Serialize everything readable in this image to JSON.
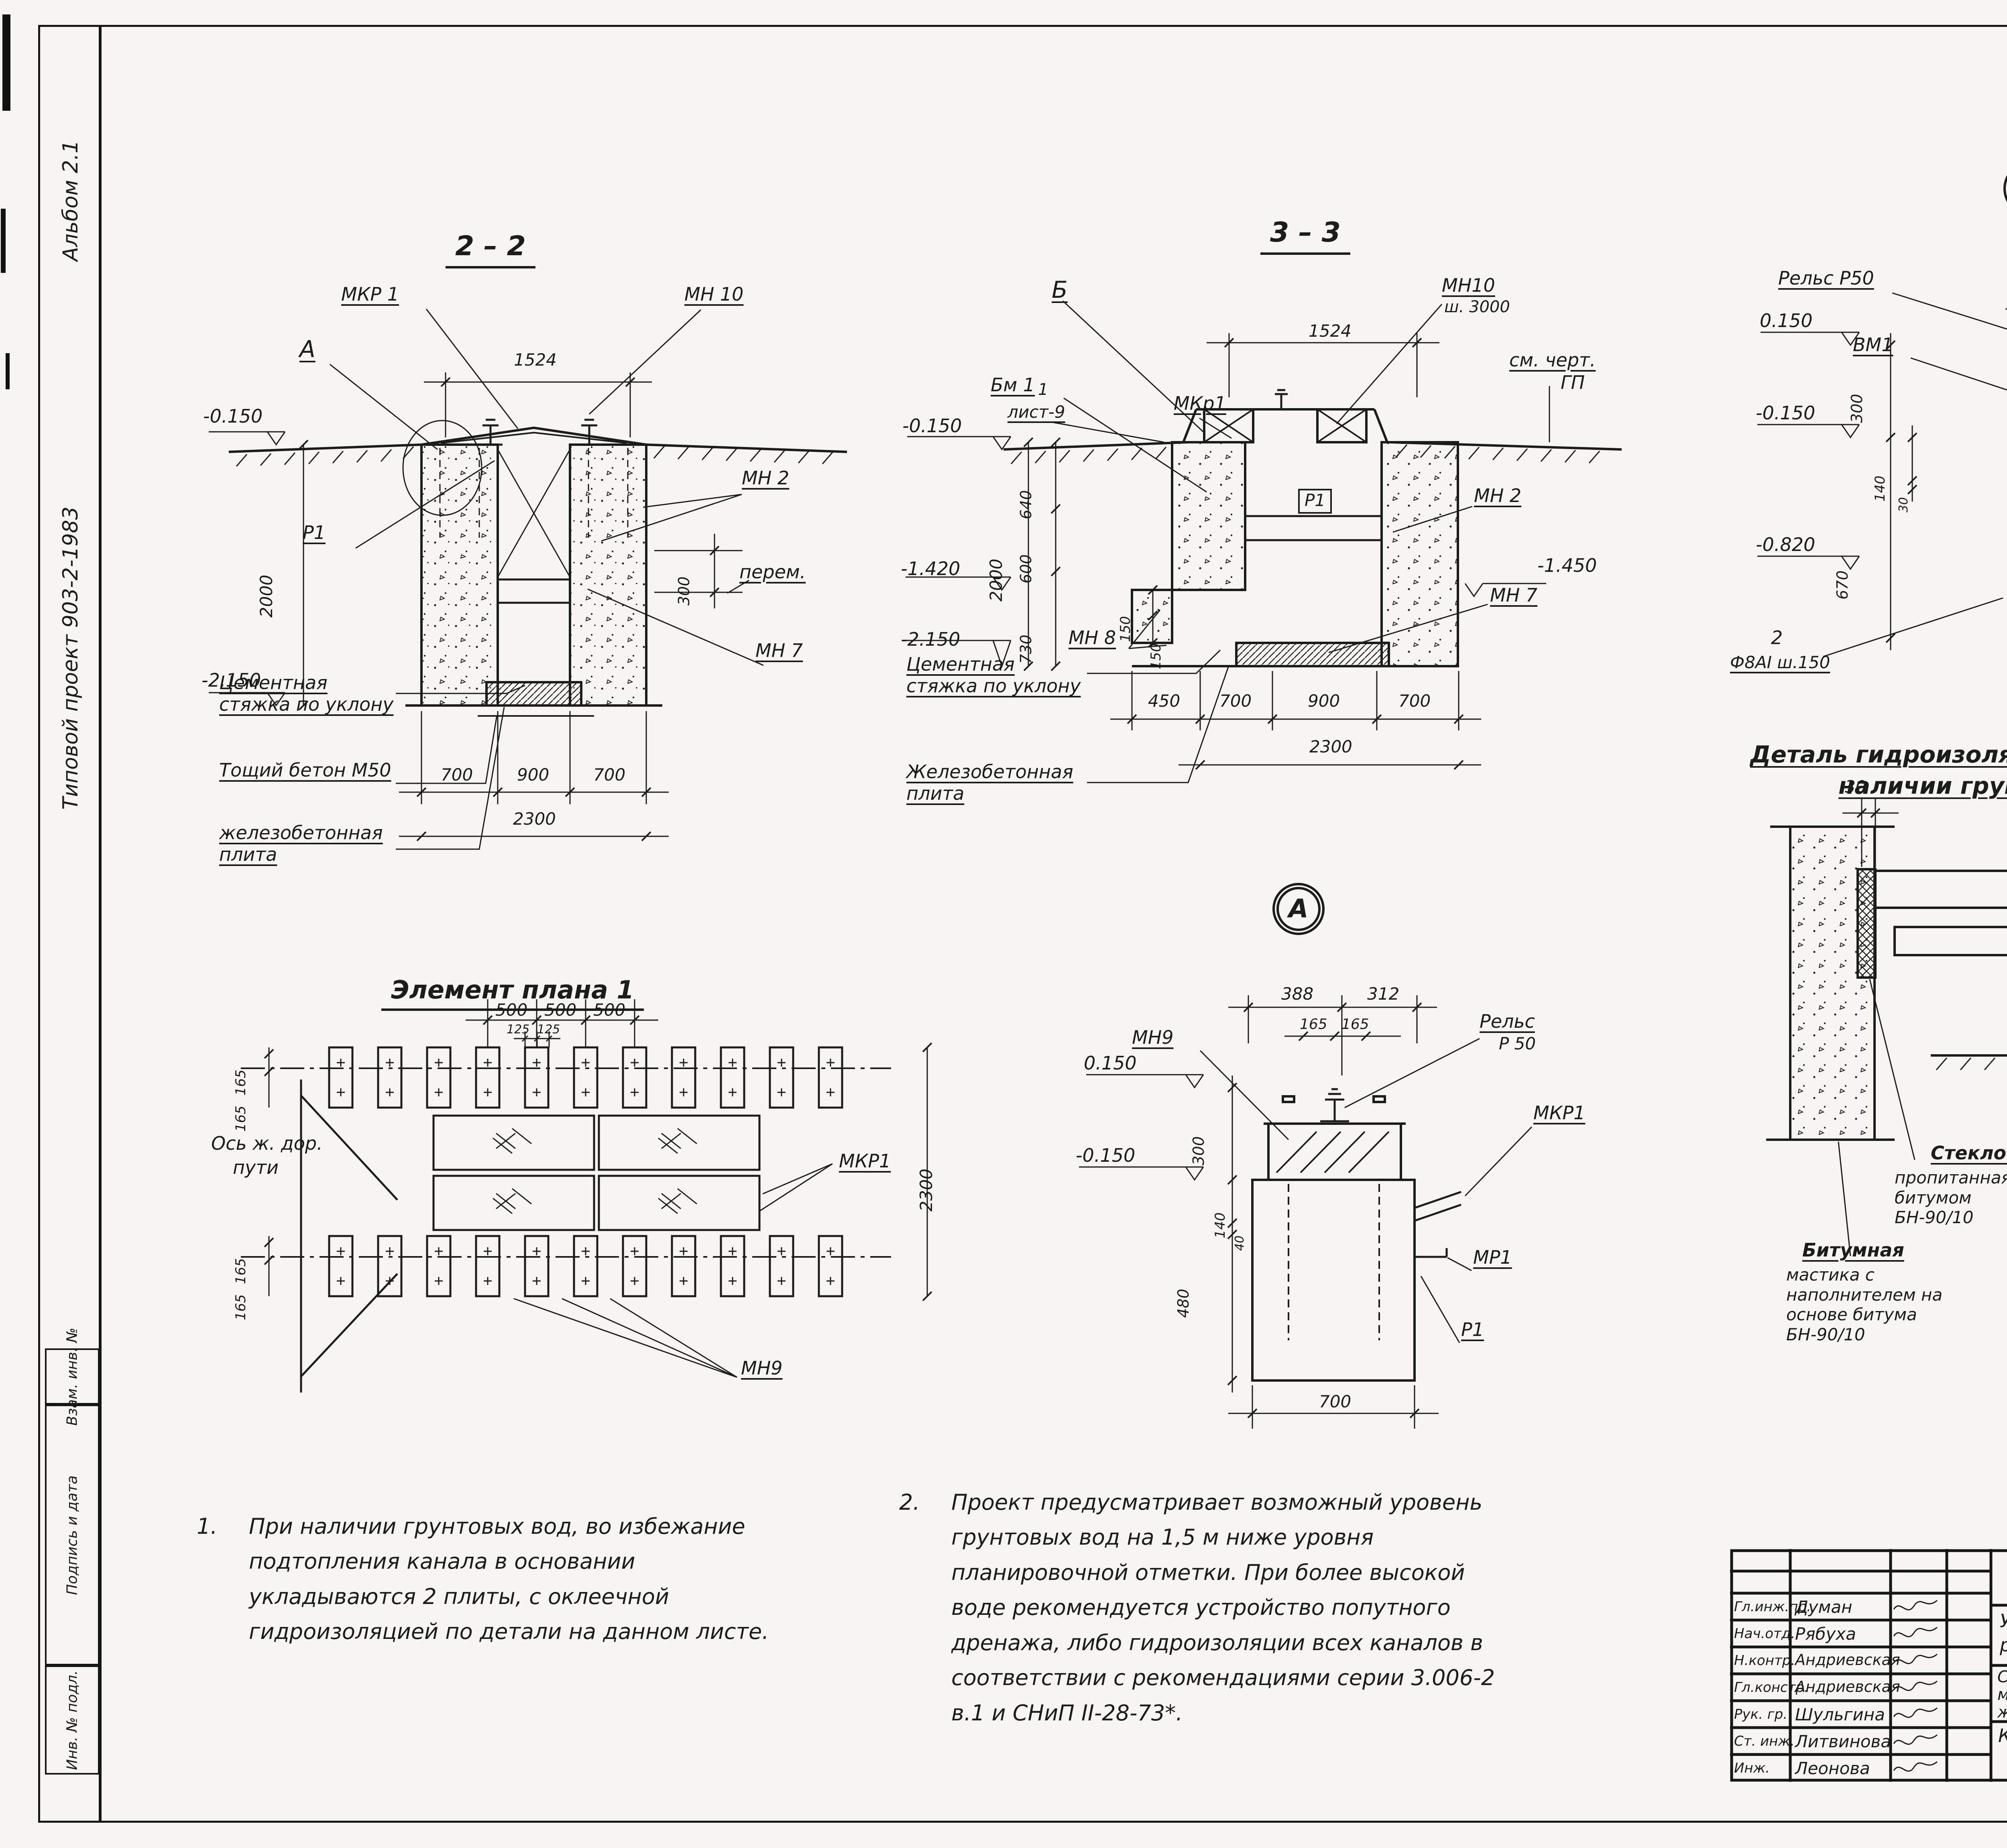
{
  "sheet": {
    "number": "24",
    "format_label": "Формат А2"
  },
  "margin": {
    "album": "Альбом 2.1",
    "project": "Типовой  проект   903-2-1983",
    "stamp_top": "Взам. инв. №",
    "stamp_mid": "Подпись и дата",
    "stamp_bottom": "Инв. № подл."
  },
  "s22": {
    "title": "2 – 2",
    "dim_1524": "1524",
    "mkr1": "МКР 1",
    "mn10": "МН 10",
    "a": "А",
    "mn2": "МН 2",
    "p1": "Р1",
    "perem": "перем.",
    "mn7": "МН 7",
    "elev_top": "-0.150",
    "elev_bot": "-2.150",
    "dim_2000": "2000",
    "dim_300": "300",
    "d700a": "700",
    "d900": "900",
    "d700b": "700",
    "d2300": "2300",
    "mat_cement": "Цементная стяжка по уклону",
    "mat_lean": "Тощий бетон М50",
    "mat_slab": "железобетонная плита"
  },
  "s33": {
    "title": "3 – 3",
    "b": "Б",
    "bm1": "Бм 1",
    "mkr1": "МКр1",
    "mn10": "МН10",
    "mn10b": "ш. 3000",
    "dim_1524": "1524",
    "gp1": "см. черт.",
    "gp2": "ГП",
    "sheet_ref_num": "1",
    "sheet_ref": "лист-9",
    "elev1": "-0.150",
    "elev2": "-1.420",
    "elev3": "-2.150",
    "elev_right": "-1.450",
    "dim_2000": "2000",
    "d640": "640",
    "d600": "600",
    "d730": "730",
    "d150a": "150",
    "d150b": "150",
    "mn2": "МН 2",
    "mn7": "МН 7",
    "mn8": "МН 8",
    "p1": "Р1",
    "d450": "450",
    "d700a": "700",
    "d900": "900",
    "d700b": "700",
    "d2300": "2300",
    "mat_cement": "Цементная стяжка по уклону",
    "mat_slab": "Железобетонная плита"
  },
  "detb": {
    "marker": "Б",
    "rail": "Рельс Р50",
    "d388": "388",
    "d312": "312",
    "d165a": "165",
    "d165b": "165",
    "vm1": "ВМ1",
    "mn9": "МН9",
    "mkr1": "МКР1",
    "p1": "Р1",
    "mp1": "МР1",
    "angle": "L 75×6; ℓ=200",
    "angle2": "шаг 3000",
    "mn2": "МН 2",
    "elev_top": "0.150",
    "elev_mid": "-0.150",
    "elev_low": "-0.820",
    "d300": "300",
    "d140": "140",
    "d30": "30",
    "d670": "670",
    "rebar2": "2",
    "rebar": "Ф8АI ш.150",
    "d20a": "20",
    "d220a": "220",
    "d220b": "220",
    "d220c": "220",
    "d20b": "20",
    "d700": "700",
    "flag1": "1",
    "rebar_bot": "10 Ф 25 АIII"
  },
  "deta": {
    "marker": "А",
    "rail": "Рельс",
    "rail2": "Р 50",
    "d388": "388",
    "d312": "312",
    "d165a": "165",
    "d165b": "165",
    "mn9": "МН9",
    "mkr1": "МКР1",
    "mp1": "МР1",
    "p1": "Р1",
    "elev_top": "0.150",
    "elev_mid": "-0.150",
    "d300": "300",
    "d140": "140",
    "d40": "40",
    "d480": "480",
    "d700": "700"
  },
  "plan": {
    "title": "Элемент плана 1",
    "d500a": "500",
    "d500b": "500",
    "d500c": "500",
    "d125a": "125",
    "d125b": "125",
    "d165a": "165",
    "d165b": "165",
    "d165c": "165",
    "d165d": "165",
    "axis1": "Ось ж. дор.",
    "axis2": "пути",
    "mkr1": "МКР1",
    "mn9": "МН9",
    "d2300": "2300"
  },
  "hydro": {
    "title1": "Деталь гидроизоляции днища при",
    "title2": "наличии грунтовых вод",
    "d30": "30",
    "elev": "-1.450",
    "d200": "200",
    "note": "Гидроизоляцию в горизонтальных швах в пределах температурного блока выполнить с устройством компенсаций аналогично деталям серии 3.006-2 в.I л. 53,54",
    "glass1": "Стеклоткань",
    "glass2": "пропитанная битумом БН-90/10",
    "bit1": "Битумная",
    "bit2": "мастика с наполнителем на основе битума БН-90/10",
    "r1": "Цементная стяжка",
    "r1b": "30 мм",
    "r2": "Железобетонная плита",
    "r3": "2 слоя стеклорубероида на битумной мастике (на основе битума БН-90/10)",
    "r4": "Железобетонная плита"
  },
  "notes": {
    "n1_num": "1.",
    "n1": "При наличии грунтовых вод, во избежание подтопления канала в основании укладываются 2 плиты, с оклеечной гидроизоляцией по детали на данном листе.",
    "n2_num": "2.",
    "n2": "Проект предусматривает возможный уровень грунтовых вод на 1,5 м ниже уровня планировочной отметки. При более высокой воде рекомендуется устройство попутного дренажа, либо гидроизоляции всех каналов в соответствии с рекомендациями серии 3.006-2 в.1 и СНиП II-28-73*."
  },
  "titleblock": {
    "doc": "ТП 903-2-1983",
    "mark": "КЖ",
    "project": "Установка мазутоснабжения Q=13 и 3,25/13м³/ч с резервуарами 2х1000 м³.",
    "object1": "Сооружения, слива",
    "object2": "мазута, слив и хранение",
    "object3": "жидких присадок.",
    "content1": "КНм1. Разрезы 2-2÷3-3.",
    "content2": "Элемент плана 1.",
    "content3": "Узлы.",
    "h_stage": "Стадия",
    "h_sheet": "Лист",
    "h_sheets": "Листов",
    "stage": "Р",
    "sheet_no": "8",
    "org": "ЛАТГИПРОПРОМ",
    "attached": "Привязан",
    "inv": "Инв. №",
    "rows": [
      {
        "role": "Гл.инж.пр.",
        "name": "Думан"
      },
      {
        "role": "Нач.отд.",
        "name": "Рябуха"
      },
      {
        "role": "Н.контр.",
        "name": "Андриевская"
      },
      {
        "role": "Гл.констр.",
        "name": "Андриевская"
      },
      {
        "role": "Рук. гр.",
        "name": "Шульгина"
      },
      {
        "role": "Ст. инж.",
        "name": "Литвинова"
      },
      {
        "role": "Инж.",
        "name": "Леонова"
      }
    ]
  }
}
